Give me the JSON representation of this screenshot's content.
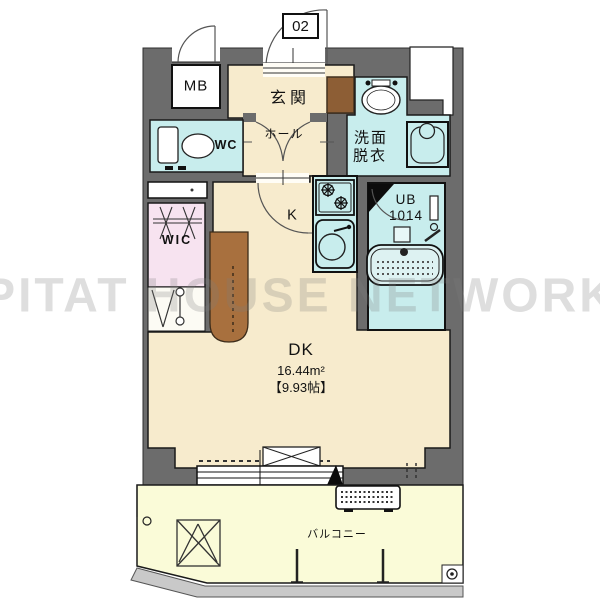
{
  "floorplan": {
    "unit_number": "02",
    "watermark": "PITAT HOUSE NETWORK",
    "labels": {
      "mb": "MB",
      "genkan": "玄関",
      "hall": "ホール",
      "wc": "WC",
      "senmen_line1": "洗面",
      "senmen_line2": "脱衣",
      "ub_line1": "UB",
      "ub_line2": "1014",
      "kitchen": "K",
      "wic": "WIC",
      "dk": "DK",
      "dk_area_sqm": "16.44m²",
      "dk_area_tatami": "【9.93帖】",
      "balcony": "バルコニー"
    },
    "fixtures": [
      "toilet-icon",
      "washbasin-icon",
      "washing-machine-pan-icon",
      "gas-stove-icon",
      "kitchen-sink-icon",
      "bathtub-icon",
      "shower-icon",
      "hanger-rod-icon",
      "evacuation-hatch-icon",
      "ac-outdoor-unit-icon",
      "sliding-window-icon",
      "door-swing-arc"
    ],
    "colors": {
      "wall": "#6c6c6c",
      "floor_cream": "#f7ebcd",
      "wet_area_blue": "#c8eded",
      "wic_pink": "#f7e3f0",
      "balcony_yellow": "#fafbd8",
      "entry_step_brown": "#8d5e35",
      "column_brown": "#a8703e",
      "outline": "#1a1a1a",
      "ground_gray": "#c9c9c9"
    }
  }
}
